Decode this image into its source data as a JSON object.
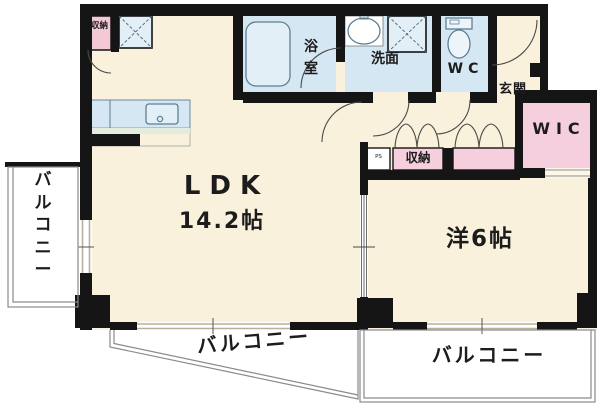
{
  "plan": {
    "labels": {
      "ldk": "LDK",
      "ldk_size": "14.2帖",
      "western_room": "洋6帖",
      "bath": "浴室",
      "washroom": "洗面",
      "wc": "WC",
      "entrance": "玄関",
      "wic": "WIC",
      "closet_kitchen": "収納",
      "closet_hall": "収納",
      "pipe_space": "PS",
      "balcony_left": "バルコニー",
      "balcony_bottom_left": "バルコニー",
      "balcony_bottom_right": "バルコニー"
    },
    "colors": {
      "floor": "#faf1dc",
      "wet": "#d4e7f2",
      "wet2": "#e2eff7",
      "pink": "#f5cfdd",
      "wall": "#151515",
      "fixture_line": "#5e7f93",
      "window": "#b8b09a",
      "balcony_line": "#8a8a8a"
    }
  }
}
